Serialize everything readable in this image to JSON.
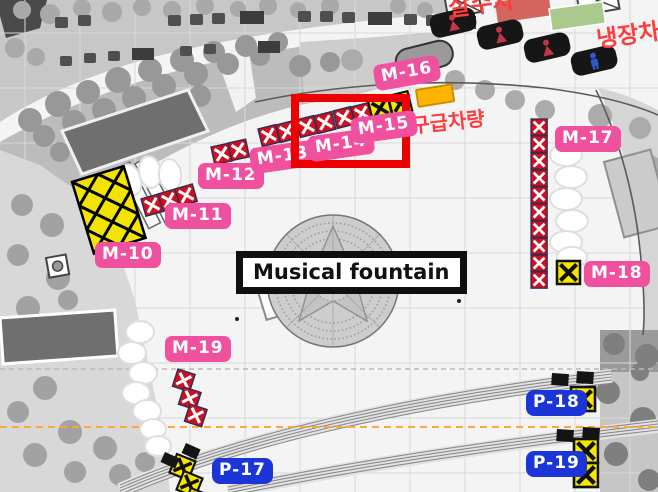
{
  "map": {
    "fountain_label": "Musical fountain",
    "annotations": {
      "ambulance_area": "구급차량",
      "refrigerated_truck": "냉장차",
      "top_truck_partial": "살수차"
    },
    "markers": {
      "m10": "M-10",
      "m11": "M-11",
      "m12": "M-12",
      "m13": "M-13",
      "m14": "M-14",
      "m15": "M-15",
      "m16": "M-16",
      "m17": "M-17",
      "m18": "M-18",
      "m19": "M-19",
      "p17": "P-17",
      "p18": "P-18",
      "p19": "P-19"
    },
    "colors": {
      "marker_pink": "#f0519f",
      "marker_blue": "#1c35d6",
      "highlight_red": "#ec0000",
      "barrier_red": "#cf1020",
      "barrier_yellow": "#f6e600",
      "vehicle_slot_orange": "#ffb400",
      "truck_red": "#d4645e",
      "truck_green": "#a9c98d",
      "restroom_female": "#c23648",
      "restroom_male": "#3355cc",
      "dashed_line_orange": "#ffa733"
    },
    "icons": {
      "red_x_barrier": "red-crossed-box",
      "yellow_x_barrier": "yellow-crossed-box",
      "restroom_female": "person-female-icon",
      "restroom_male": "person-male-icon",
      "tent": "x-roof-tent-icon",
      "fountain": "mandala-circle"
    }
  }
}
